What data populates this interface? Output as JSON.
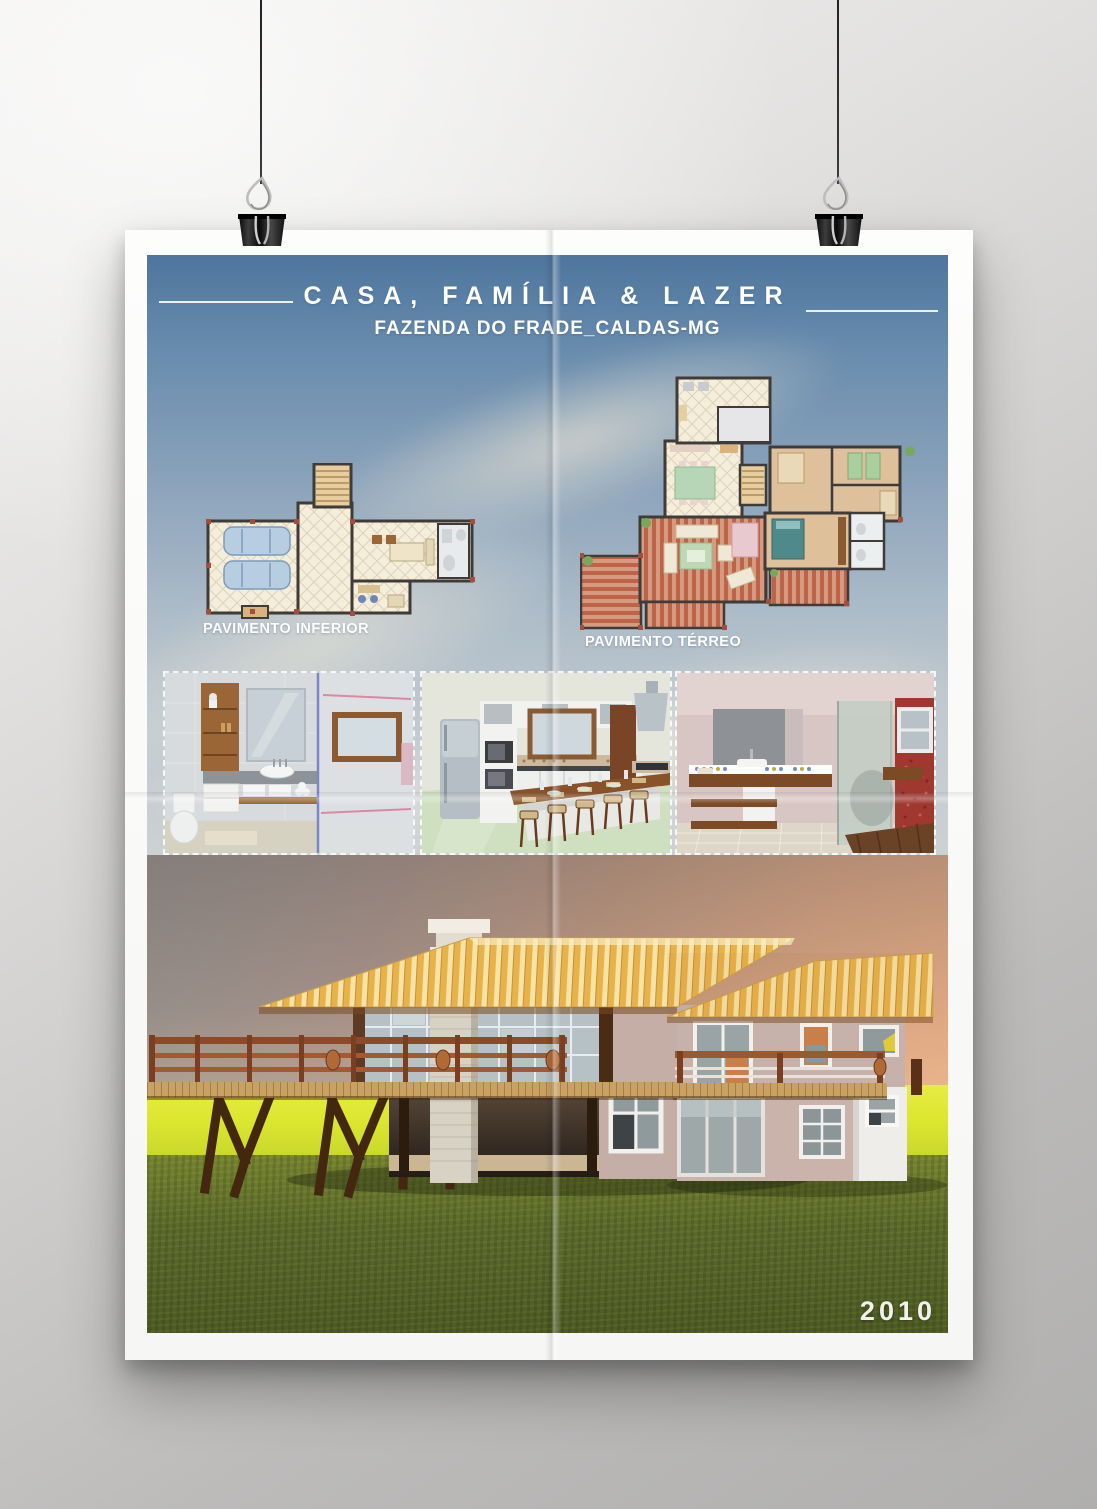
{
  "poster": {
    "title": "CASA, FAMÍLIA & LAZER",
    "subtitle": "FAZENDA DO FRADE_CALDAS-MG",
    "year": "2010",
    "floor_plans": [
      {
        "label": "PAVIMENTO INFERIOR"
      },
      {
        "label": "PAVIMENTO TÉRREO"
      }
    ],
    "interior_renders": [
      {
        "name": "bathroom-render"
      },
      {
        "name": "kitchen-render"
      },
      {
        "name": "suite-bathroom-render"
      }
    ],
    "exterior_render": {
      "name": "house-exterior-render"
    },
    "colors": {
      "sky_top": "#4e759e",
      "sky_bottom": "#ccd1d2",
      "sunset_left": "#97908c",
      "sunset_right": "#e7ac85",
      "field_green": "#dce72f",
      "grass_green": "#5b692c",
      "roof_gold": "#e8b24a",
      "wood_brown": "#8c4a28",
      "plan_floor": "#f4eeda",
      "plan_deck": "#c0694f",
      "text_white": "#ffffff"
    }
  },
  "scene": {
    "hardware": [
      "binder-clip-left",
      "binder-clip-right"
    ]
  }
}
